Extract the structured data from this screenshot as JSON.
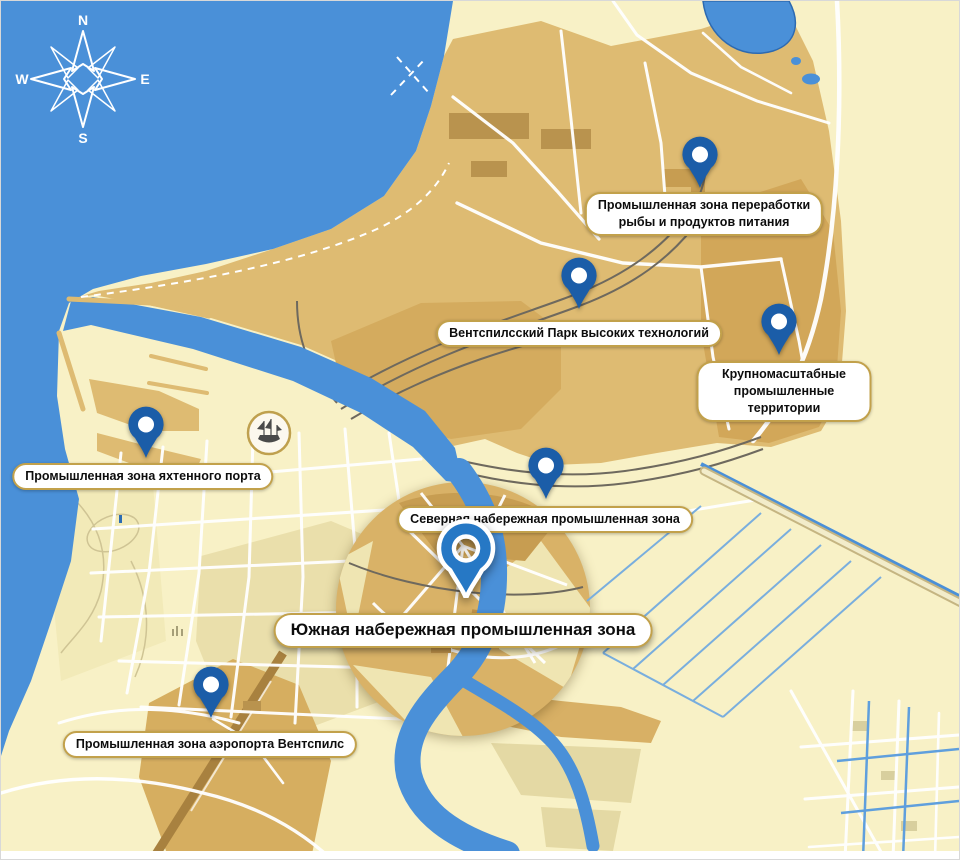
{
  "compass": {
    "north": "N",
    "east": "E",
    "south": "S",
    "west": "W"
  },
  "pins": [
    {
      "id": "fish-processing",
      "label": "Промышленная зона переработки\nрыбы и продуктов питания",
      "highlighted": false
    },
    {
      "id": "high-tech-park",
      "label": "Вентспилсский Парк высоких технологий",
      "highlighted": false
    },
    {
      "id": "large-scale",
      "label": "Крупномасштабные промышленные территории",
      "highlighted": false
    },
    {
      "id": "yacht-port",
      "label": "Промышленная зона яхтенного порта",
      "highlighted": false
    },
    {
      "id": "northern-quay",
      "label": "Северная набережная промышленная зона",
      "highlighted": false
    },
    {
      "id": "southern-quay",
      "label": "Южная набережная промышленная зона",
      "highlighted": true
    },
    {
      "id": "airport",
      "label": "Промышленная зона аэропорта Вентспилс",
      "highlighted": false
    }
  ],
  "colors": {
    "water": "#4a90d8",
    "land": "#f8f1c6",
    "industrial_zone": "#debb72",
    "industrial_dark": "#d2a759",
    "khaki_blocks": "#eadfab",
    "road": "#ffffff",
    "rail": "#6e695e",
    "pin": "#1b5da8",
    "pin_highlight": "#2678c5",
    "label_border": "#c2a14b",
    "runway": "#a8813f"
  }
}
